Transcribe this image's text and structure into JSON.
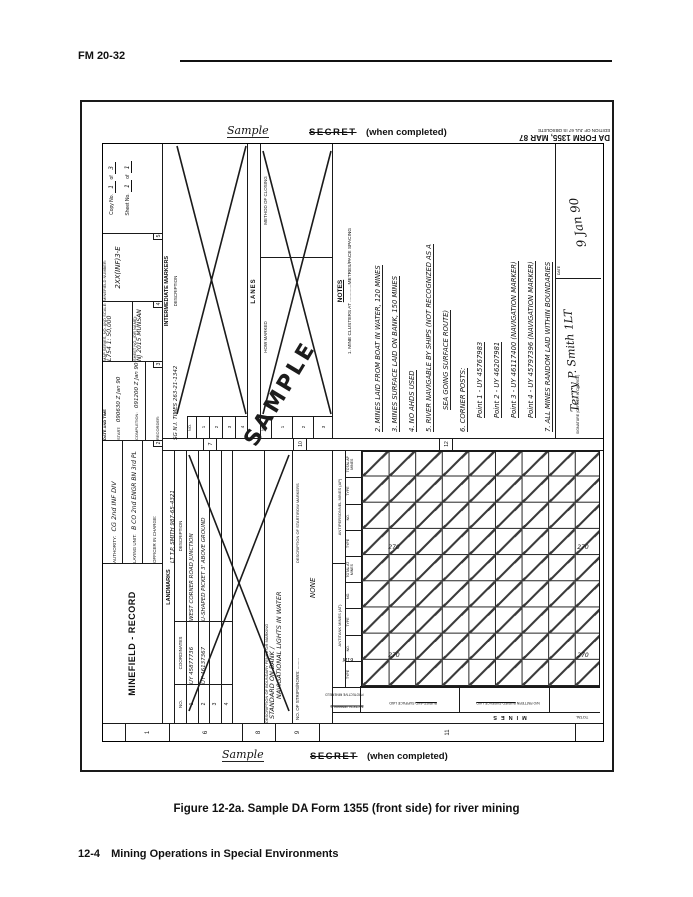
{
  "page": {
    "doc_ref": "FM 20-32",
    "caption": "Figure 12-2a. Sample DA Form 1355 (front side) for river mining",
    "footer_page": "12-4",
    "footer_title": "Mining Operations in Special Environments"
  },
  "stamps": {
    "sample": "Sample",
    "secret": "SECRET",
    "when_completed": "(when completed)",
    "da_form": "DA FORM 1355, MAR 87",
    "edition": "EDITION OF JUL 67 IS OBSOLETE",
    "watermark": "SAMPLE"
  },
  "header_row": {
    "section_no": "1",
    "title": "MINEFIELD - RECORD",
    "authority_label": "AUTHORITY:",
    "authority_value": "CG 2nd INF DIV",
    "laying_unit_label": "LAYING UNIT:",
    "laying_unit_value": "B CO 2nd ENGR BN 3rd PL",
    "oic_label": "OFFICER IN CHARGE:",
    "oic_value": "LT T.P. SMITH 987-65-4321",
    "sec2": "2",
    "datetime_label": "DATE AND TIME",
    "start_label": "START:",
    "start_value": "090630 Z Jan 90",
    "completion_label": "COMPLETION:",
    "completion_value": "091200 Z Jan 90",
    "recorder_label": "RECORDER:",
    "recorder_value": "SG N.I. TIMES 263-21-1342",
    "sec3": "3",
    "map_series_label": "MAP SERIES, NO. AND SCALE:",
    "map_series_value": "L754  1: 50,000",
    "sheet_name_label": "SHEET NO. (OR NAME):",
    "sheet_name_value": "NJ  2015 MUNSAN",
    "sec4": "4",
    "minefield_number_label": "MINEFIELD NUMBER:",
    "minefield_number_value": "2XX(INF)3-E",
    "sec5": "5",
    "copy_label": "Copy No.",
    "copy_value": "1",
    "of_label": "of",
    "copy_total": "3",
    "sheet_label": "Sheet No.",
    "sheet_value": "1",
    "sheet_total": "1"
  },
  "landmarks": {
    "section_no": "6",
    "header": "LANDMARKS",
    "col_no": "NO.",
    "col_coordinates": "COORDINATES",
    "col_description": "DESCRIPTION",
    "rows": [
      {
        "no": "1",
        "coordinates": "UY 45877736",
        "description": "WEST CORNER ROAD JUNCTION"
      },
      {
        "no": "2",
        "coordinates": "UY 46137367",
        "description": "U-SHAPED PICKET 3' ABOVE GROUND"
      },
      {
        "no": "3",
        "coordinates": "",
        "description": ""
      },
      {
        "no": "4",
        "coordinates": "",
        "description": ""
      }
    ]
  },
  "intermediate_markers": {
    "section_no": "7",
    "header": "INTERMEDIATE MARKERS",
    "col_no": "NO.",
    "col_description": "DESCRIPTION",
    "row_numbers": [
      "1",
      "2",
      "3",
      "4"
    ]
  },
  "boundary": {
    "section_no": "8",
    "label": "DESCRIPTION OF BOUNDARY FENCE OR MARKING",
    "value_line1": "STANDARD ON BANK /",
    "value_line2": "NAVIGATIONAL LIGHTS IN WATER"
  },
  "strips": {
    "section_no": "9",
    "label": "NO. OF STRIPS/ROWS: .........",
    "marker_label": "DESCRIPTION OF START/ROW MARKERS",
    "value": "NONE"
  },
  "lanes": {
    "section_no": "10",
    "header": "LANES",
    "col_no": "NO.",
    "col_how_marked": "HOW MARKED",
    "col_method": "METHOD OF CLOSING",
    "row_numbers": [
      "1",
      "2",
      "3"
    ]
  },
  "mines": {
    "section_no": "11",
    "section_label": "MINES",
    "total_label": "TOTAL",
    "group_at": "ANTITANK MINES (AT)",
    "group_ap": "ANTIPERSONNEL MINES (AP)",
    "col_labels": [
      "TYPE",
      "NO.",
      "TYPE",
      "NO.",
      "TOTAL AT MINES",
      "TYPE",
      "NO.",
      "TYPE",
      "TOTAL AP MINES"
    ],
    "type_value": "M19",
    "row_values": [
      "270",
      "270"
    ],
    "total_values": [
      "270",
      "270"
    ],
    "stub_header1": "TACTICAL MINEFIELD",
    "stub_header2": "PROTECTIVE MINEFIELD",
    "stub_cell1_strike": "BURIED AND",
    "stub_cell1_rest": "SURFACE LAID",
    "stub_cell2_rest": "N/O PATTERN",
    "stub_cell2_strike": "BURIED  SURFACE LAID"
  },
  "notes": {
    "section_no": "12",
    "header": "NOTES",
    "printed_line": "1. MINE CLUSTERS AT .............METRES/PACE SPACING",
    "lines": [
      "2.  MINES LAID FROM BOAT IN WATER, 120 MINES",
      "3.  MINES SURFACE LAID ON BANK, 150 MINES",
      "4.  NO AHDS USED",
      "5.  RIVER NAVIGABLE BY SHIPS (NOT RECOGNIZED AS A",
      "SEA GOING SURFACE ROUTE)",
      "6.  CORNER POSTS:",
      "Point 1 - UY 45767983",
      "Point 2 - UY 46207981",
      "Point 3 - UY 46117400  (NAVIGATION MARKER)",
      "Point 4 - UY 45797396  (NAVIGATION MARKER)",
      "7.  ALL MINES RANDOM LAID WITHIN BOUNDARIES"
    ],
    "signature_label": "SIGNATURE (OFFICER IN CHARGE)",
    "signature_value": "Terry P. Smith  1LT",
    "date_label": "DATE",
    "date_value": "9 Jan 90"
  },
  "band_numbers": {
    "n1": "1",
    "n6": "6",
    "n8": "8",
    "n9": "9",
    "n11": "11"
  }
}
